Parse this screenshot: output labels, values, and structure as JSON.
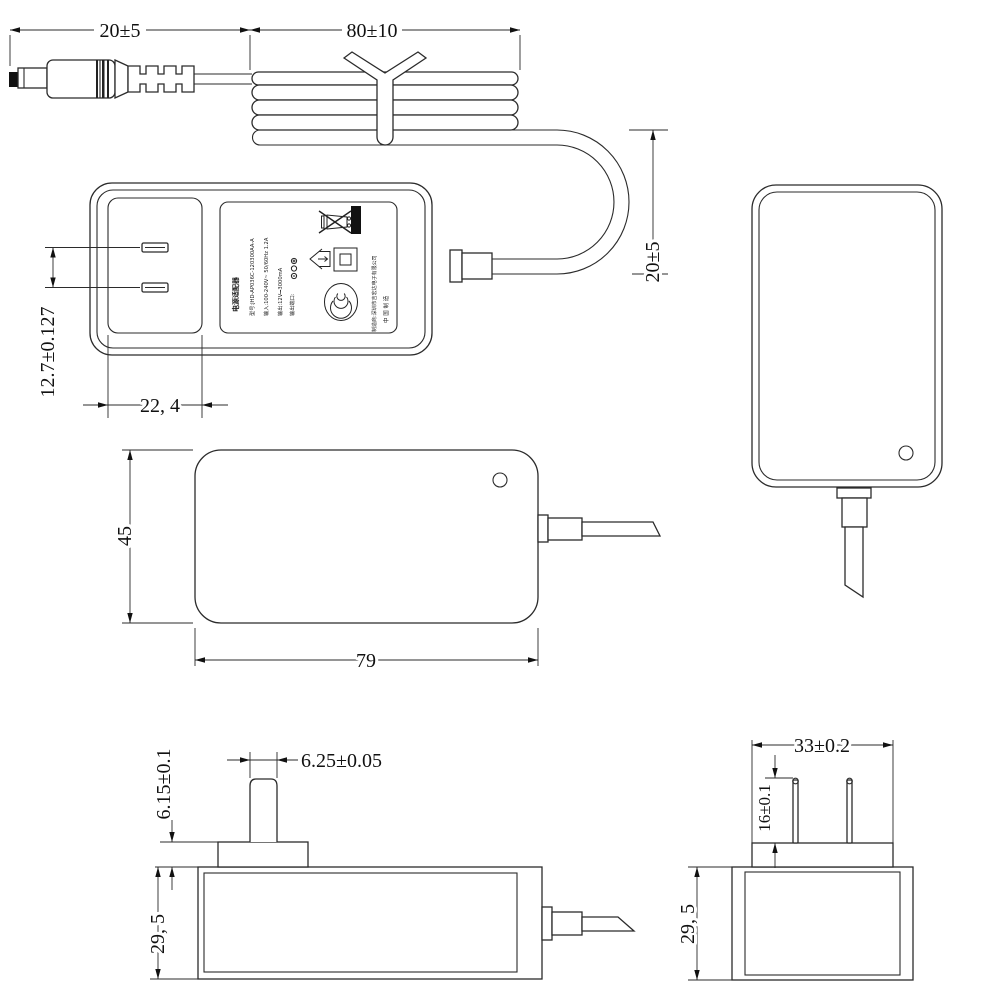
{
  "document": {
    "type": "technical-dimension-drawing",
    "subject": "wall plug power adapter with DC cable",
    "background_color": "#ffffff",
    "line_color": "#2b2b2b"
  },
  "views": {
    "cable_top": {
      "dim_plug_length": "20±5",
      "dim_coil_length": "80±10",
      "dim_loop_height": "20±5"
    },
    "adapter_front": {
      "dim_blade_gap": "12.7±0.127",
      "dim_recess_width": "22, 4",
      "label": {
        "title": "电源适配器",
        "model_line": "型号:JHD-AP036C-120300AA-A",
        "input_line": "输入:100-240V~ 50/60Hz 1.2A",
        "output_line": "输出:12V⎓3000mA",
        "port_line": "输出端口:",
        "manufacturer_line": "制造商:深圳市吉宏达电子有限公司",
        "made_in_line": "中 国 制 造",
        "icons": [
          "weee-crossed-bin-icon",
          "black-bar-icon",
          "indoor-use-icon",
          "class-ii-icon",
          "ccc-mark-icon",
          "dc-polarity-icon"
        ]
      }
    },
    "adapter_side": {
      "dim_height": "45",
      "dim_width": "79"
    },
    "adapter_back": {},
    "adapter_bottom_side": {
      "dim_blade_width": "6.25±0.05",
      "dim_base_height": "6.15±0.1",
      "dim_thickness": "29, 5"
    },
    "adapter_bottom_end": {
      "dim_base_width": "33±0.2",
      "dim_blade_length": "16±0.1",
      "dim_thickness": "29, 5"
    }
  }
}
